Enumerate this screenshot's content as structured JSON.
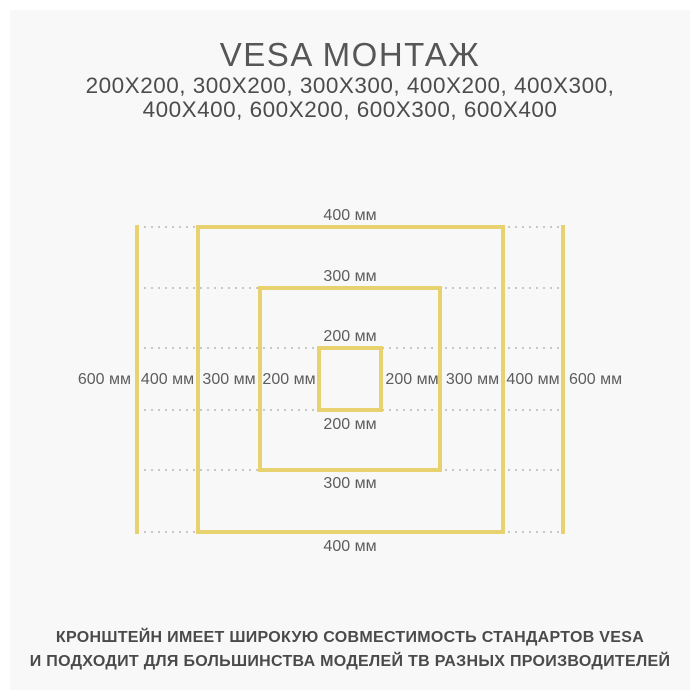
{
  "header": {
    "title": "VESA МОНТАЖ",
    "sizes_line1": "200X200, 300X200, 300X300, 400X200, 400X300,",
    "sizes_line2": "400X400, 600X200, 600X300, 600X400"
  },
  "diagram": {
    "unit": "мм",
    "square_sizes_mm": [
      200,
      300,
      400,
      600
    ],
    "top_labels": [
      "400 мм",
      "300 мм",
      "200 мм"
    ],
    "bottom_labels": [
      "200 мм",
      "300 мм",
      "400 мм"
    ],
    "left_labels": [
      "600 мм",
      "400 мм",
      "300 мм",
      "200 мм"
    ],
    "right_labels": [
      "200 мм",
      "300 мм",
      "400 мм",
      "600 мм"
    ]
  },
  "footer": {
    "line1": "КРОНШТЕЙН ИМЕЕТ ШИРОКУЮ СОВМЕСТИМОСТЬ СТАНДАРТОВ VESA",
    "line2": "И ПОДХОДИТ ДЛЯ БОЛЬШИНСТВА МОДЕЛЕЙ ТВ РАЗНЫХ ПРОИЗВОДИТЕЛЕЙ"
  },
  "colors": {
    "accent_yellow": "#e8d26f",
    "guide_gray": "#c7c7c7",
    "text_dark": "#4a4a4a",
    "label_gray": "#5d5d5d",
    "panel_bg": "#f8f8f9"
  }
}
